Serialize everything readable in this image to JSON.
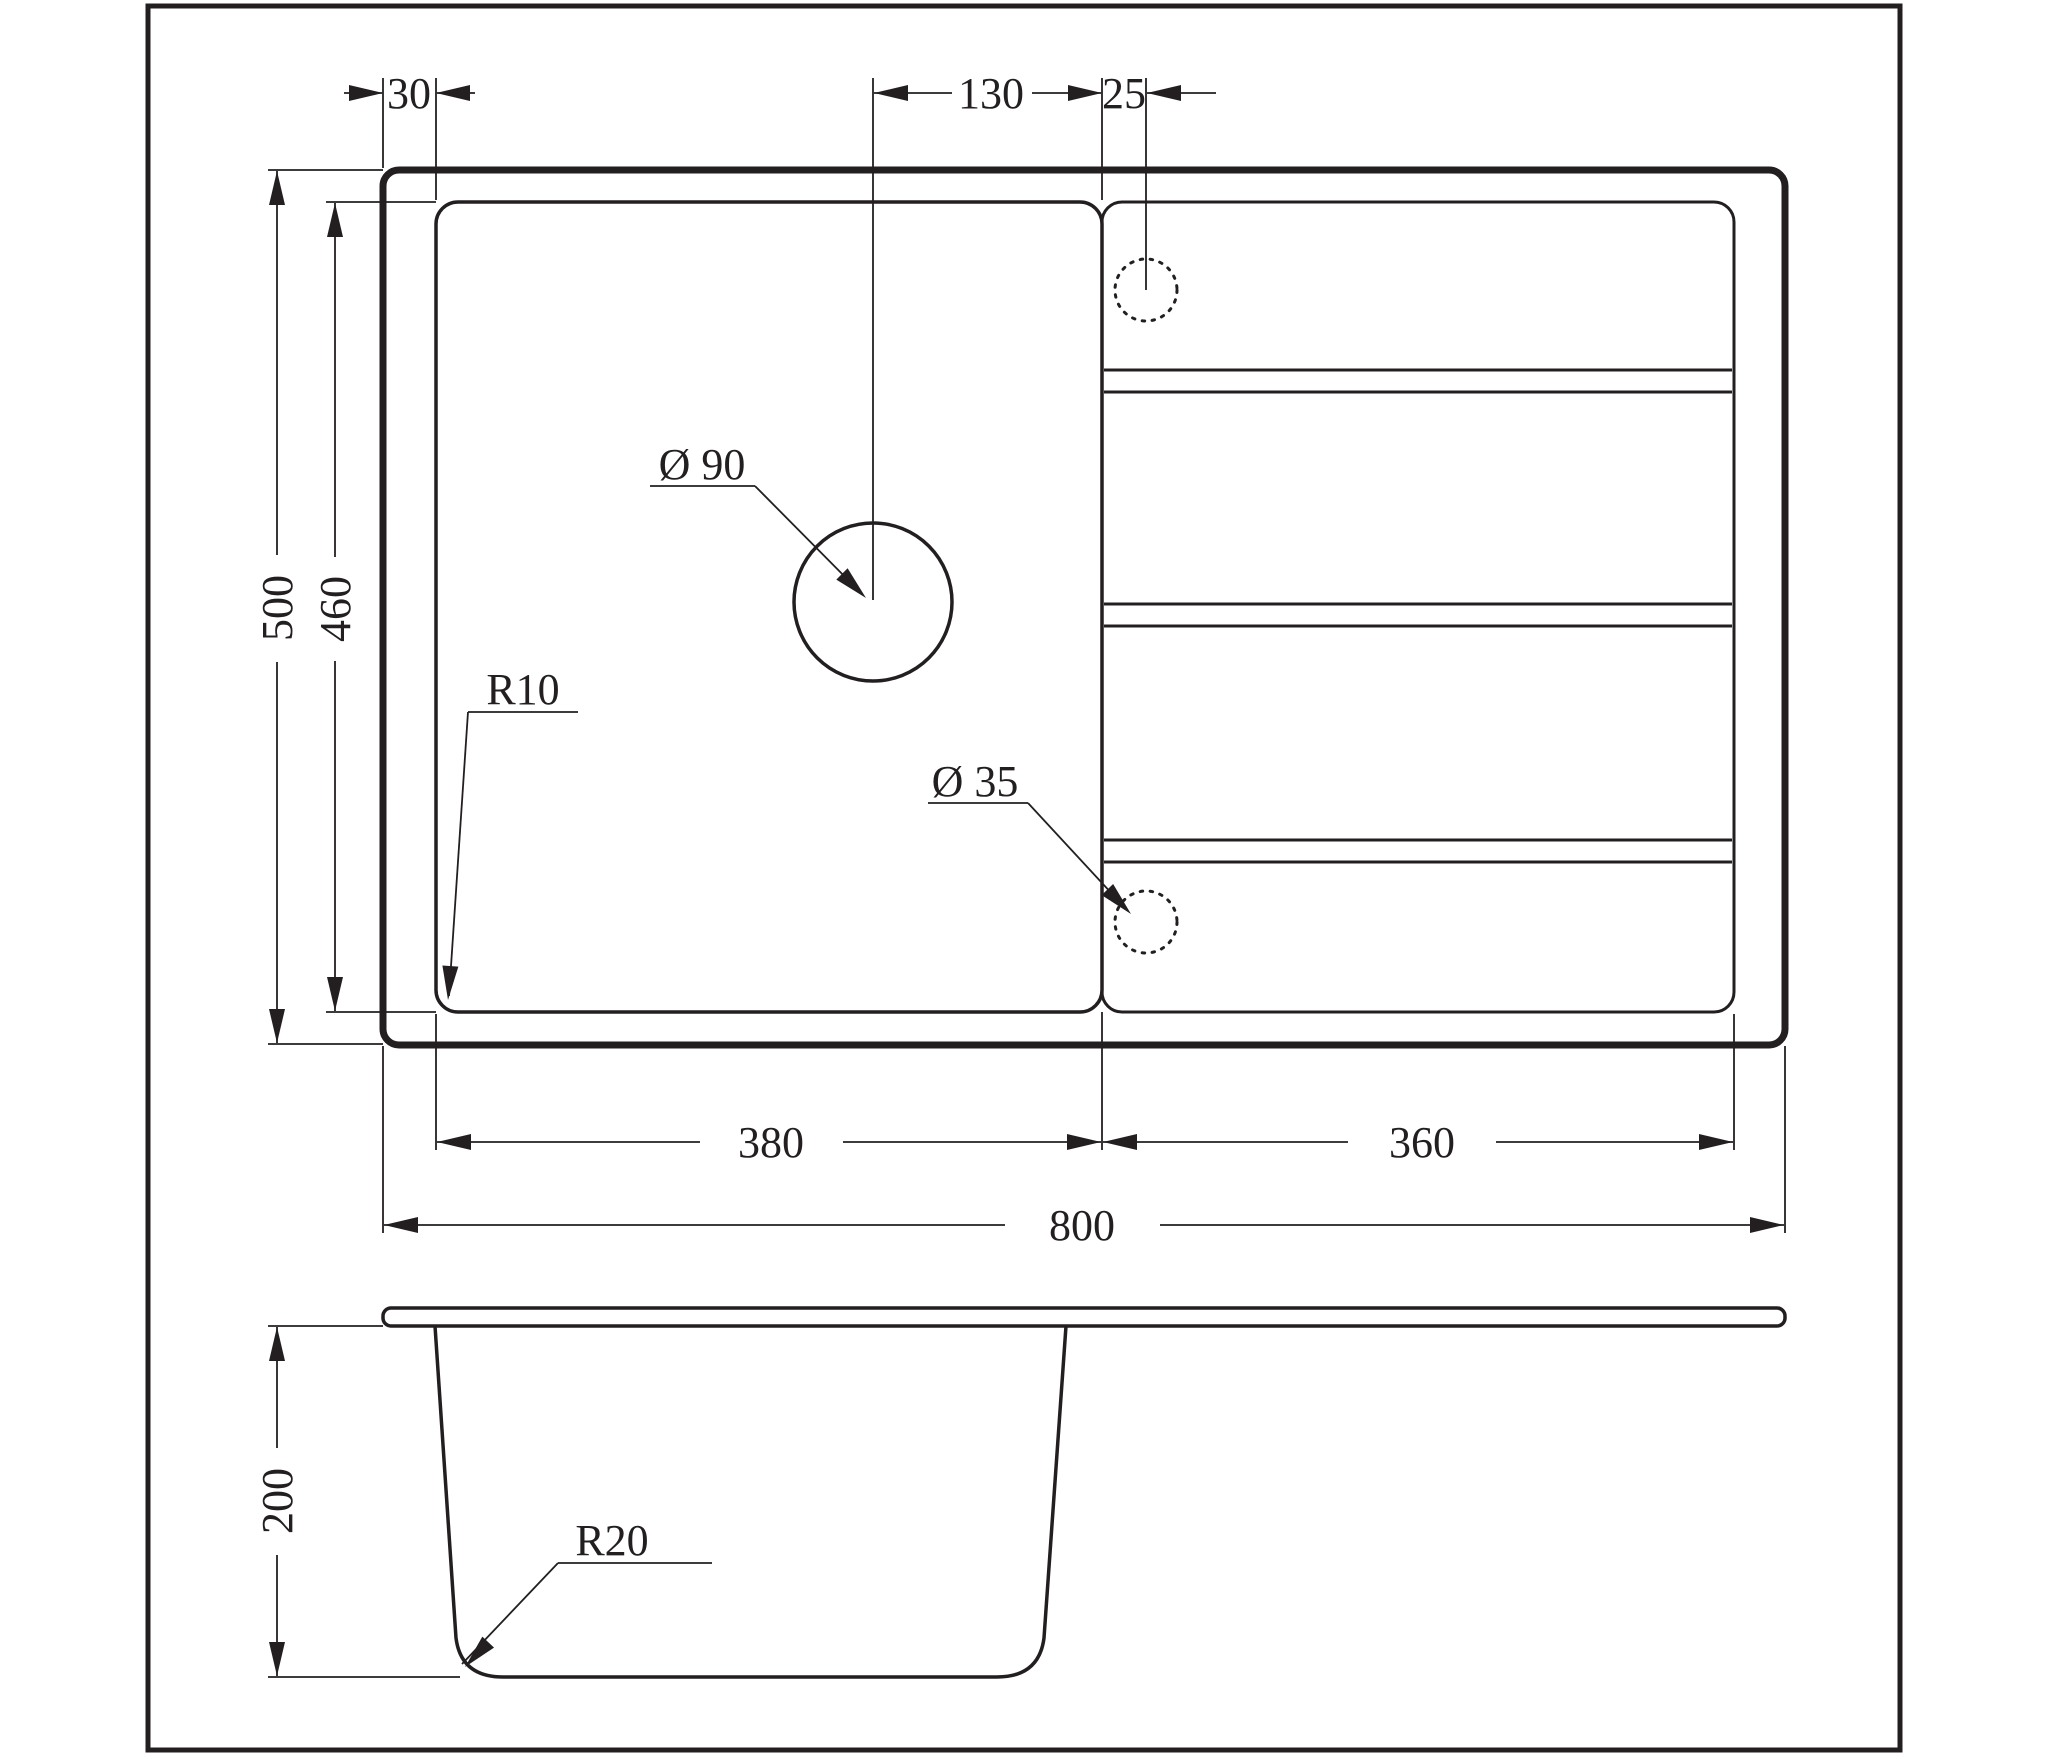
{
  "page": {
    "background": "#ffffff",
    "line_color": "#231f20",
    "description_labels_units": "mm"
  },
  "labels": {
    "offset_30": "30",
    "offset_130": "130",
    "offset_25": "25",
    "height_500": "500",
    "height_460": "460",
    "width_380": "380",
    "width_360": "360",
    "width_800": "800",
    "depth_200": "200",
    "dia_90": "Ø 90",
    "dia_35": "Ø 35",
    "radius_10": "R10",
    "radius_20": "R20"
  }
}
